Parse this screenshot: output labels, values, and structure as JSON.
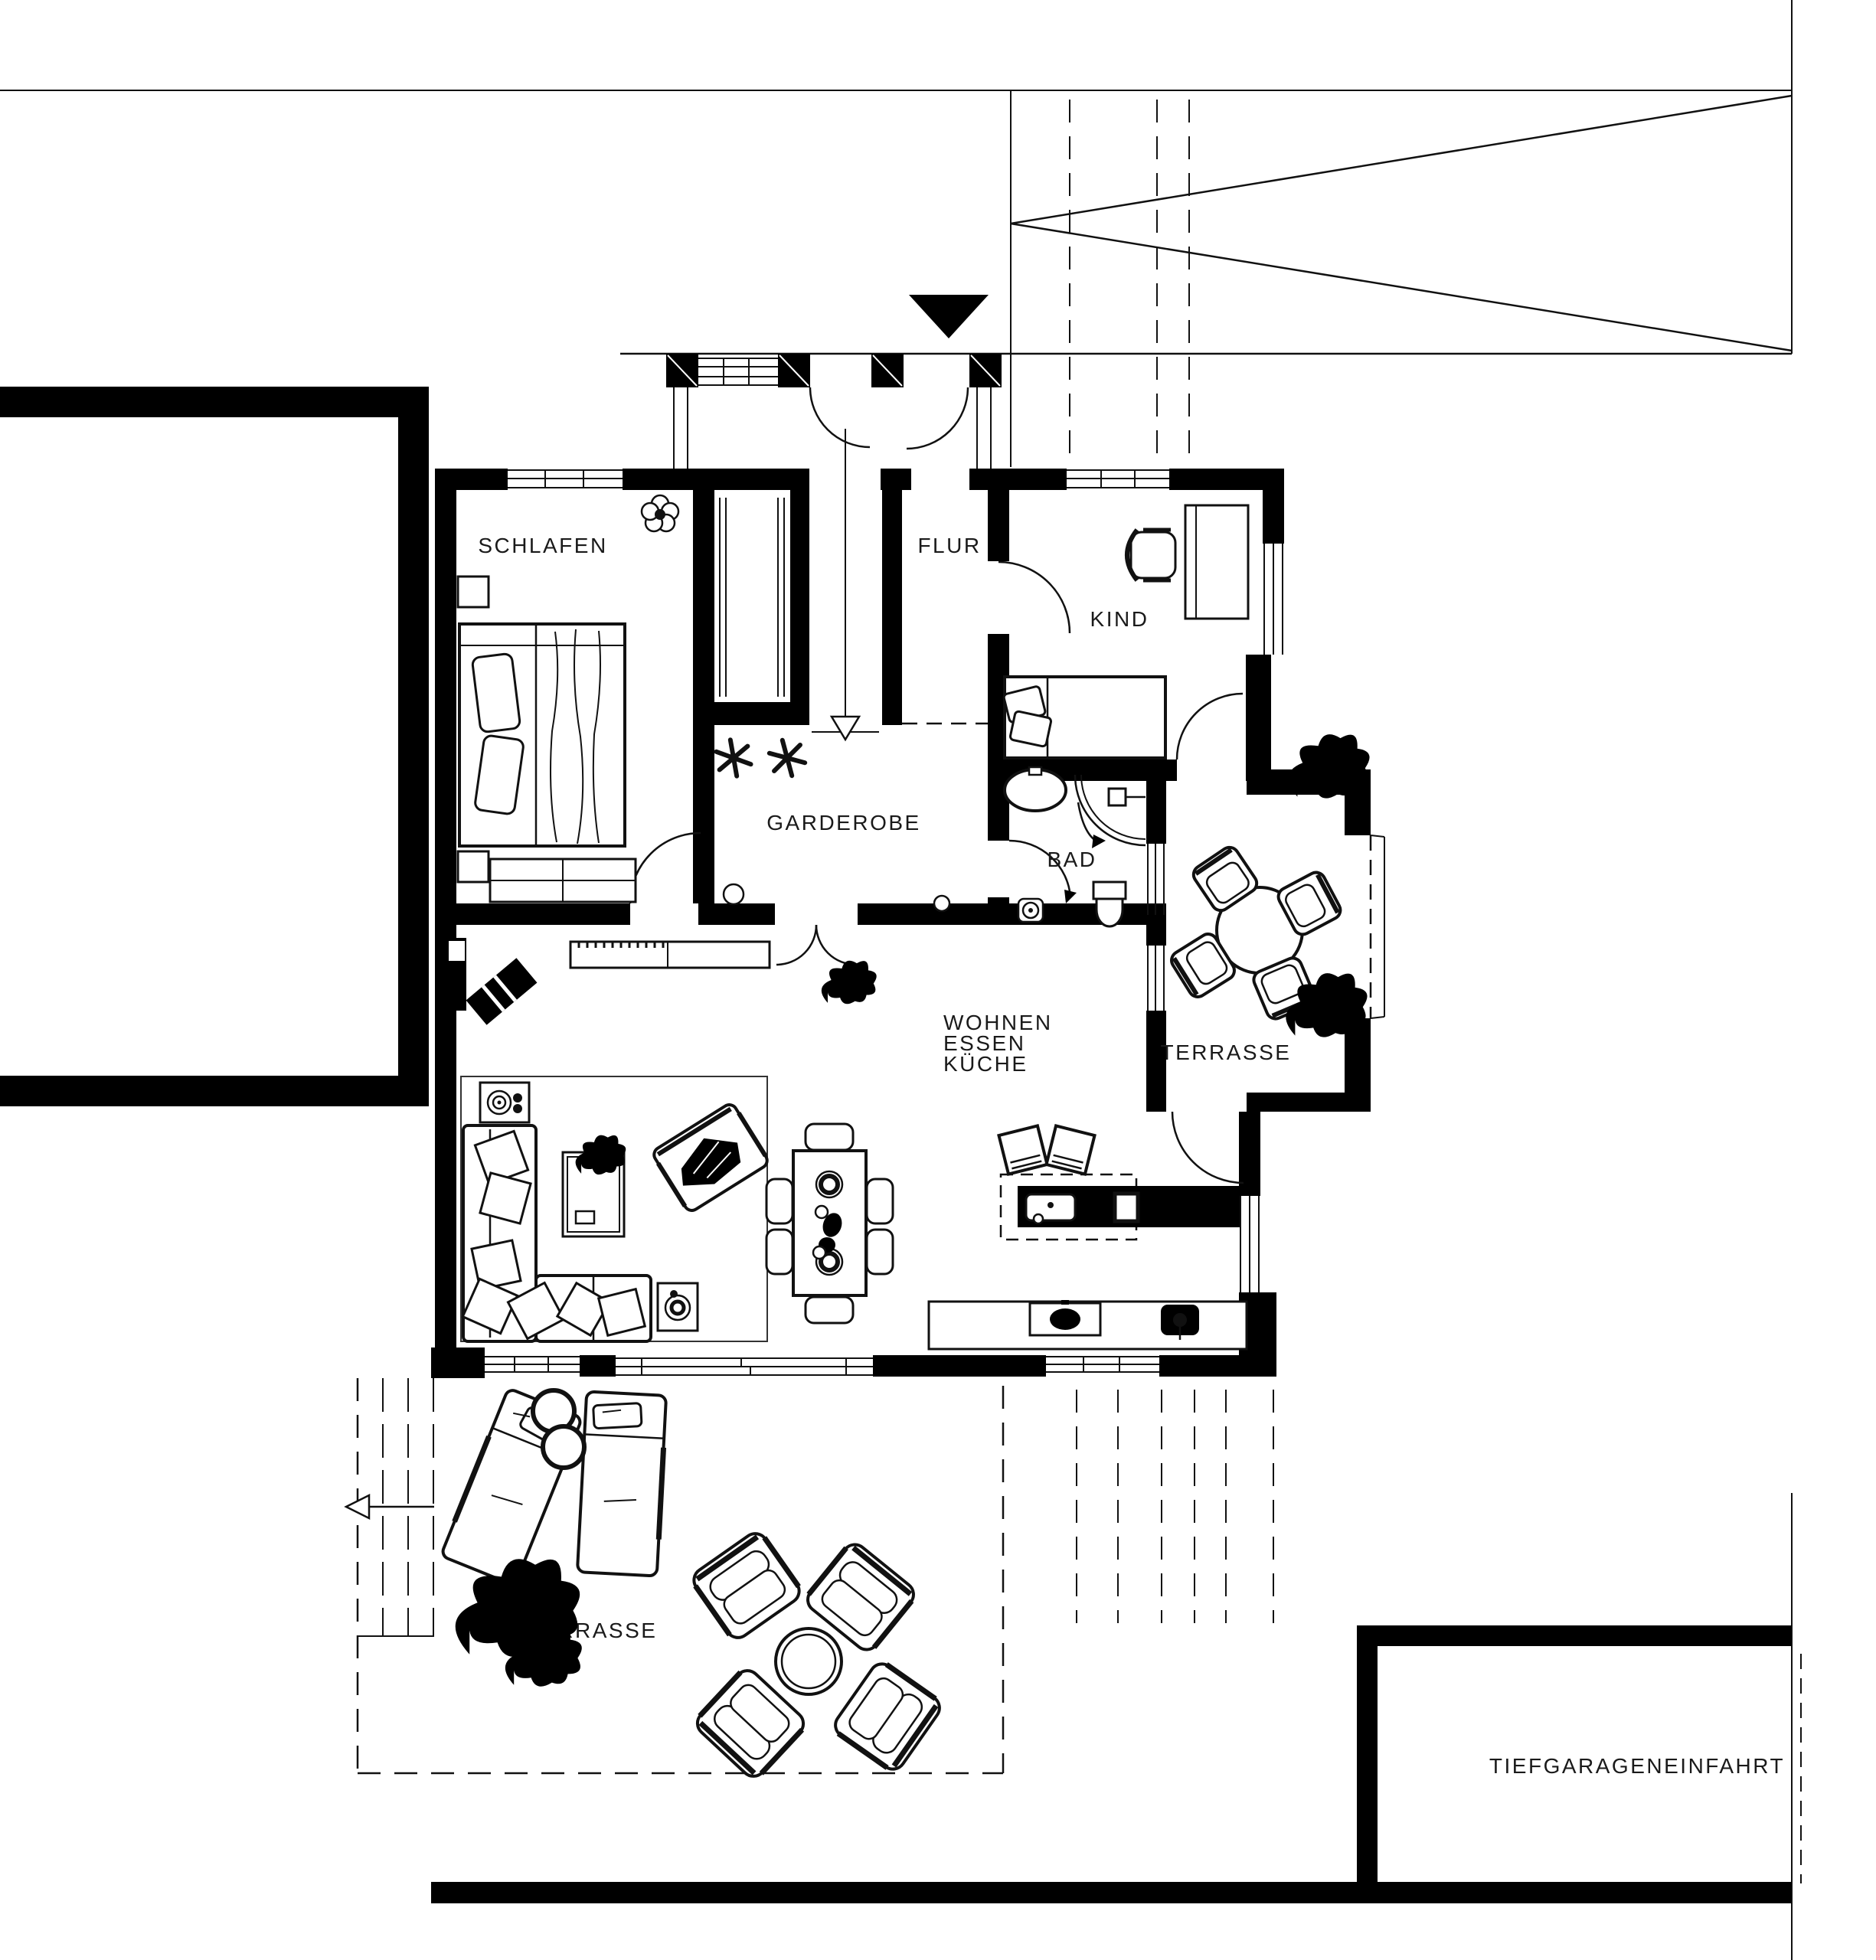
{
  "plan": {
    "title_visible": false,
    "labels": {
      "schlafen": "SCHLAFEN",
      "flur": "FLUR",
      "kind": "KIND",
      "garderobe": "GARDEROBE",
      "bad": "BAD",
      "wohnen": "WOHNEN",
      "essen": "ESSEN",
      "kueche": "KÜCHE",
      "terrasse": "TERRASSE",
      "tiefgarage": "TIEFGARAGENEINFAHRT"
    },
    "colors": {
      "wall": "#000000",
      "line": "#111111",
      "text": "#1a1a1a",
      "background": "#ffffff"
    },
    "symbols": {
      "entrance_marker": "filled-triangle-down",
      "entry_axis": "arrow-down-open",
      "stair_direction": "arrow-left-open",
      "coat_hooks": "asterisk",
      "ramp": "zigzag-triangles"
    }
  }
}
